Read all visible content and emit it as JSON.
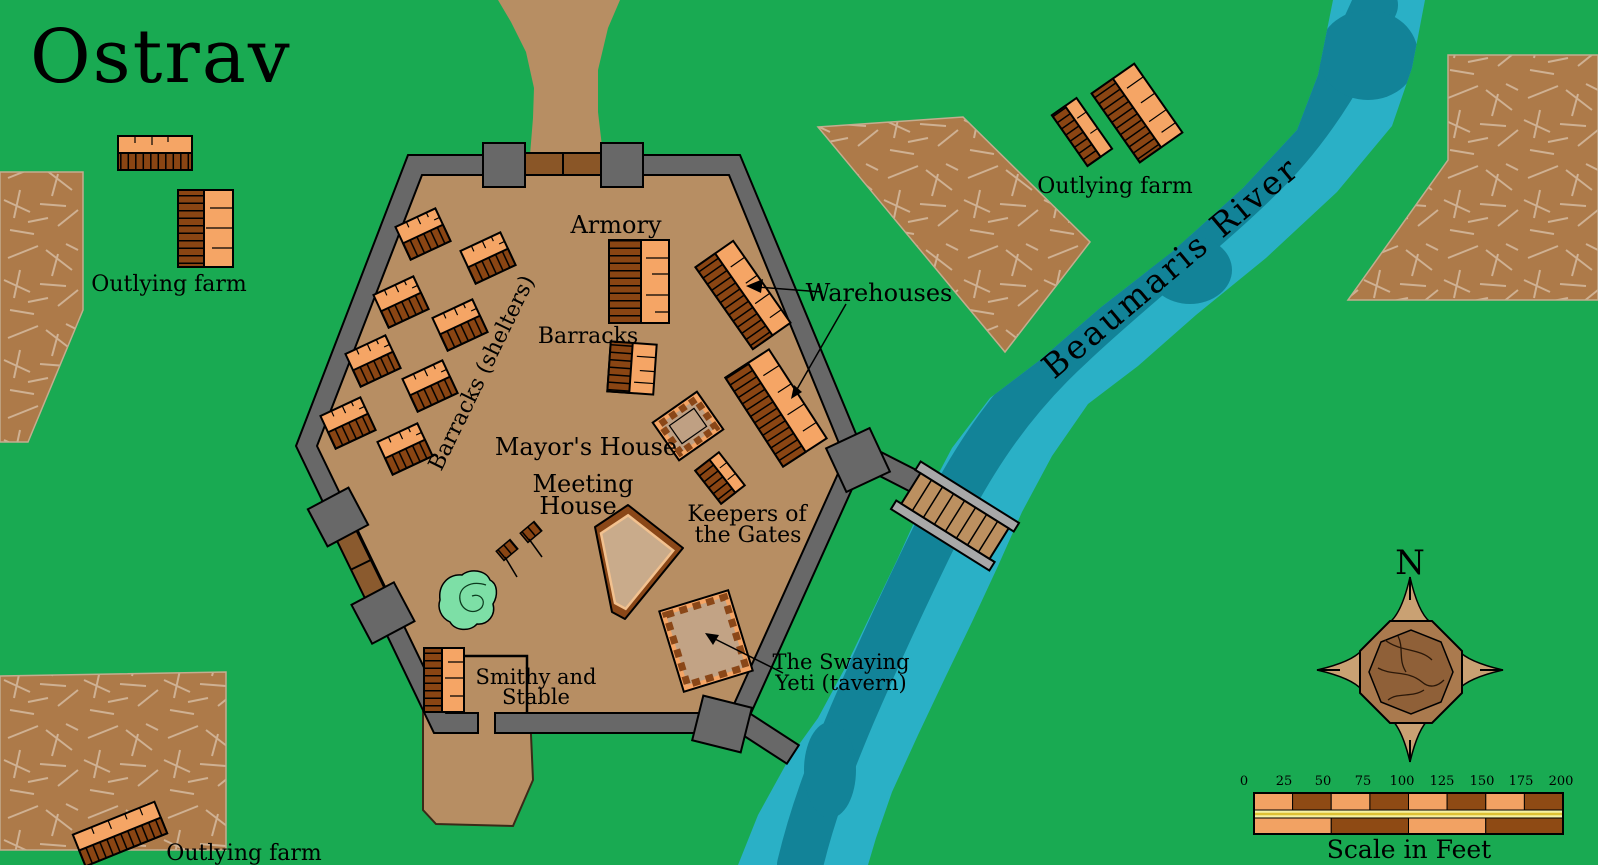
{
  "title": "Ostrav",
  "labels": {
    "farm_nw": "Outlying farm",
    "farm_sw": "Outlying farm",
    "farm_ne": "Outlying farm",
    "river": "Beaumaris River",
    "armory": "Armory",
    "barracks": "Barracks",
    "barracks_shelters": "Barracks (shelters)",
    "mayors_house": "Mayor's House",
    "meeting_house_line1": "Meeting",
    "meeting_house_line2": "House",
    "keepers_line1": "Keepers of",
    "keepers_line2": "the Gates",
    "warehouses": "Warehouses",
    "smithy_line1": "Smithy and",
    "smithy_line2": "Stable",
    "tavern_line1": "The Swaying",
    "tavern_line2": "Yeti (tavern)"
  },
  "compass": {
    "north": "N"
  },
  "scale_bar": {
    "ticks": [
      "0",
      "25",
      "50",
      "75",
      "100",
      "125",
      "150",
      "175",
      "200"
    ],
    "caption": "Scale in Feet",
    "feet_per_segment": 25
  },
  "colors": {
    "grass": "#19aa52",
    "ground": "#b78e63",
    "wall_gray": "#686868",
    "gate_brown": "#8a5a2e",
    "field_brown": "#ad7a49",
    "field_scribble": "#cfb193",
    "building_orange": "#f5a565",
    "roof_brown": "#8a4513",
    "river_light": "#2ab0c6",
    "river_dark": "#128398",
    "tree_green": "#7ddfa6",
    "scale_orange": "#f2a263",
    "scale_brown": "#8e4a14",
    "scale_yellow": "#f6f1a3"
  }
}
